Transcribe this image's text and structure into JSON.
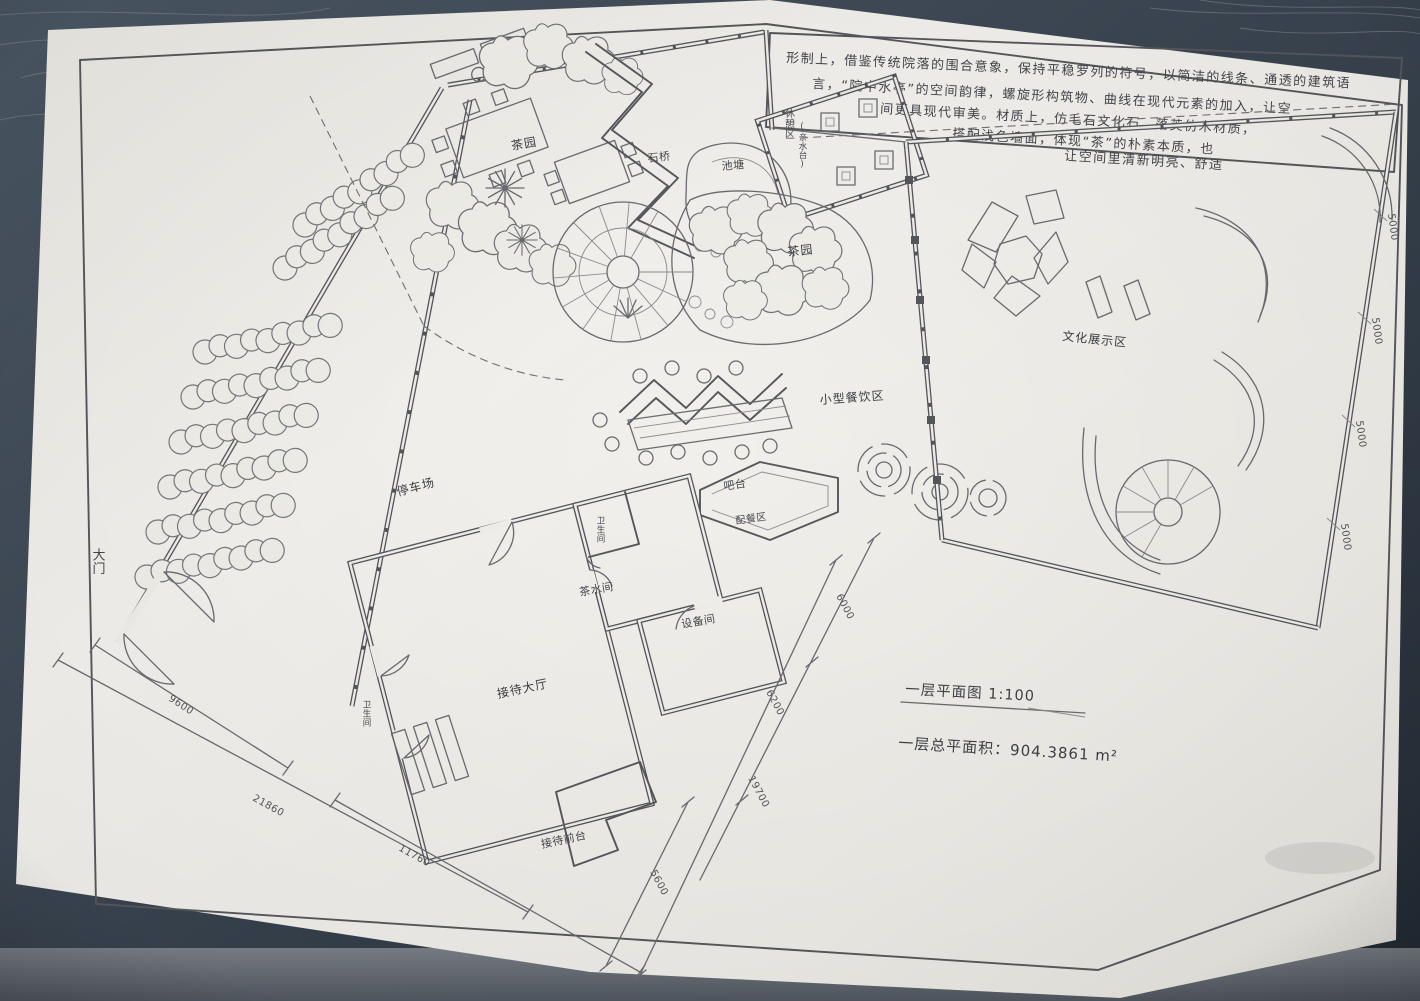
{
  "scene": {
    "background": "#333d49",
    "paper": "#efeee9",
    "ink": "#5f6166"
  },
  "annotation": {
    "lines": [
      "形制上，借鉴传统院落的围合意象，保持平稳罗列的符号，以简洁的线条、通透的建筑语",
      "言，“院中水亭”的空间韵律，螺旋形构筑物、曲线在现代元素的加入，让空",
      "间更具现代审美。材质上，仿毛石文化石、落英仿木材质，",
      "搭配浅色墙面，体现“茶”的朴素本质，也",
      "让空间里清新明亮、舒适"
    ]
  },
  "labels": {
    "tea_garden_left": "茶园",
    "stone_bridge": "石桥",
    "pond": "池塘",
    "rest_area": "休憩区",
    "rest_area_sub": "(亲水台)",
    "tea_garden_right": "茶园",
    "culture_zone": "文化展示区",
    "dining_zone": "小型餐饮区",
    "bar": "吧台",
    "pantry": "配餐区",
    "tea_room": "茶水间",
    "equipment_room": "设备间",
    "restroom_small": "卫生间",
    "reception_hall": "接待大厅",
    "reception_desk": "接待前台",
    "restroom_west": "卫生间",
    "parking": "停车场",
    "main_gate": "大门"
  },
  "dimensions": {
    "west_inner": "9600",
    "west_outer": "21860",
    "south_inner": "11760",
    "south_right": "5600",
    "east_seg_a": "6000",
    "east_seg_b": "6200",
    "east_total": "19700",
    "edge_segments": [
      "5000",
      "5000",
      "5000",
      "5000"
    ]
  },
  "titleblock": {
    "plan_title": "一层平面图 1:100",
    "area_note": "一层总平面积：904.3861 m²"
  }
}
